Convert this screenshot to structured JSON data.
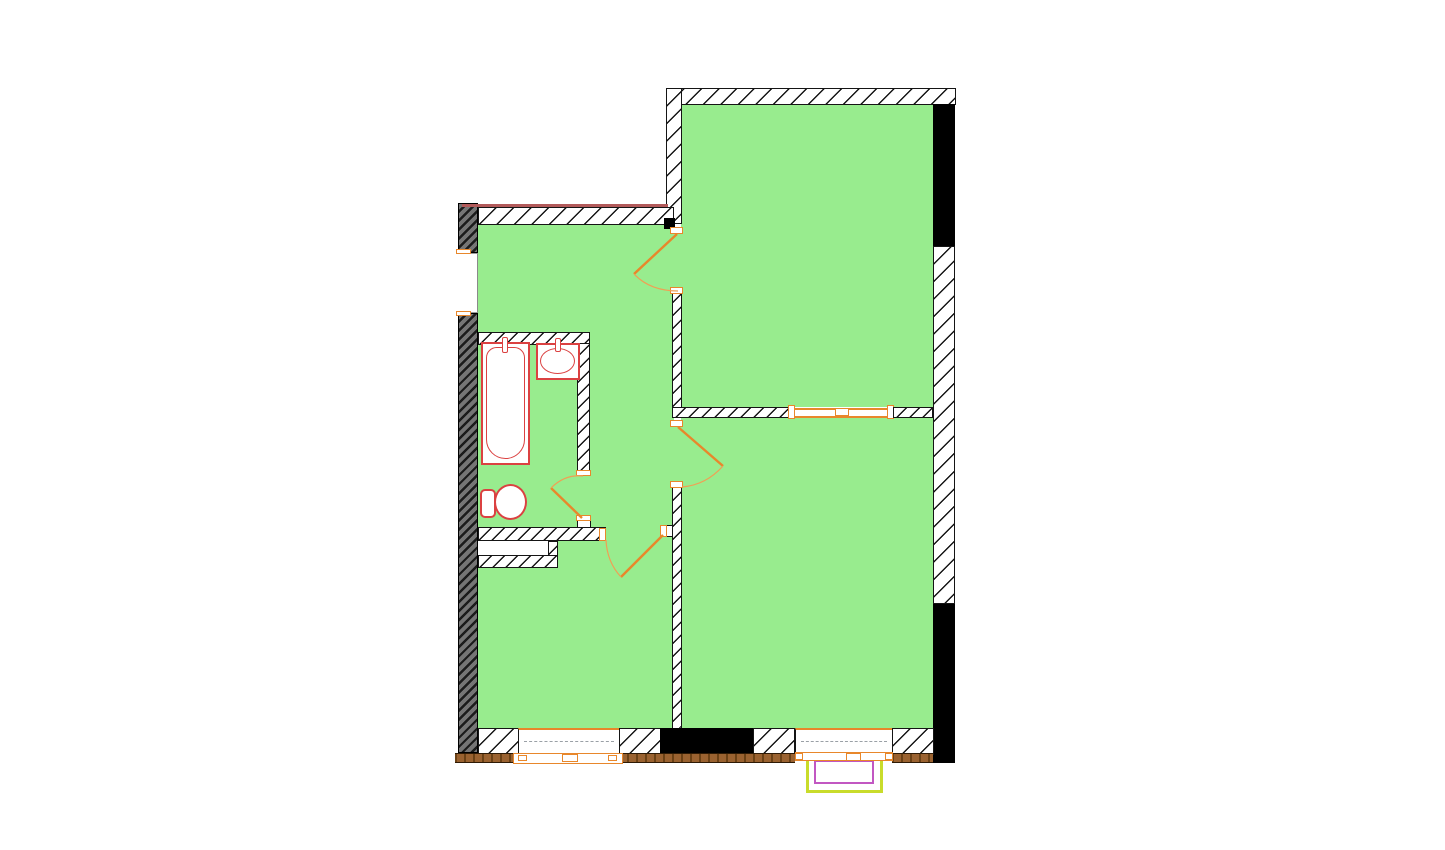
{
  "meta": {
    "type": "architectural floor plan",
    "description": "2-room apartment floor plan drawing, no text labels visible"
  },
  "colors": {
    "room-fill": "#98EC8E",
    "wall-line": "#151515",
    "outer-dark-wall": "#757575",
    "black-fill": "#000000",
    "fixture-red": "#DB4141",
    "door-orange": "#E8872B",
    "arc-orange": "#F0A054",
    "baseline-brown": "#9A6230",
    "baseline-brown-dark": "#6B4115",
    "accent-darkred": "#B25A5A",
    "balcony-outline": "#C9DC2B",
    "balcony-inner": "#C257C2",
    "window-dash": "#9aa0a6"
  },
  "rooms": [
    {
      "name": "room-top-right",
      "fill": "#98EC8E"
    },
    {
      "name": "room-bottom-right",
      "fill": "#98EC8E"
    },
    {
      "name": "hall",
      "fill": "#98EC8E"
    },
    {
      "name": "bathroom",
      "fill": "#98EC8E"
    },
    {
      "name": "kitchen-bottom-left",
      "fill": "#98EC8E"
    }
  ],
  "fixtures": [
    {
      "name": "bathtub"
    },
    {
      "name": "sink"
    },
    {
      "name": "toilet"
    }
  ],
  "openings": [
    {
      "name": "entry-opening",
      "wall": "left"
    },
    {
      "name": "door-top-right-room"
    },
    {
      "name": "door-bottom-right-room"
    },
    {
      "name": "door-kitchen"
    },
    {
      "name": "door-bathroom"
    },
    {
      "name": "wide-opening-between-right-rooms"
    },
    {
      "name": "window-kitchen",
      "wall": "bottom"
    },
    {
      "name": "window-bottom-right-room",
      "wall": "bottom"
    },
    {
      "name": "balcony",
      "side": "bottom"
    }
  ]
}
